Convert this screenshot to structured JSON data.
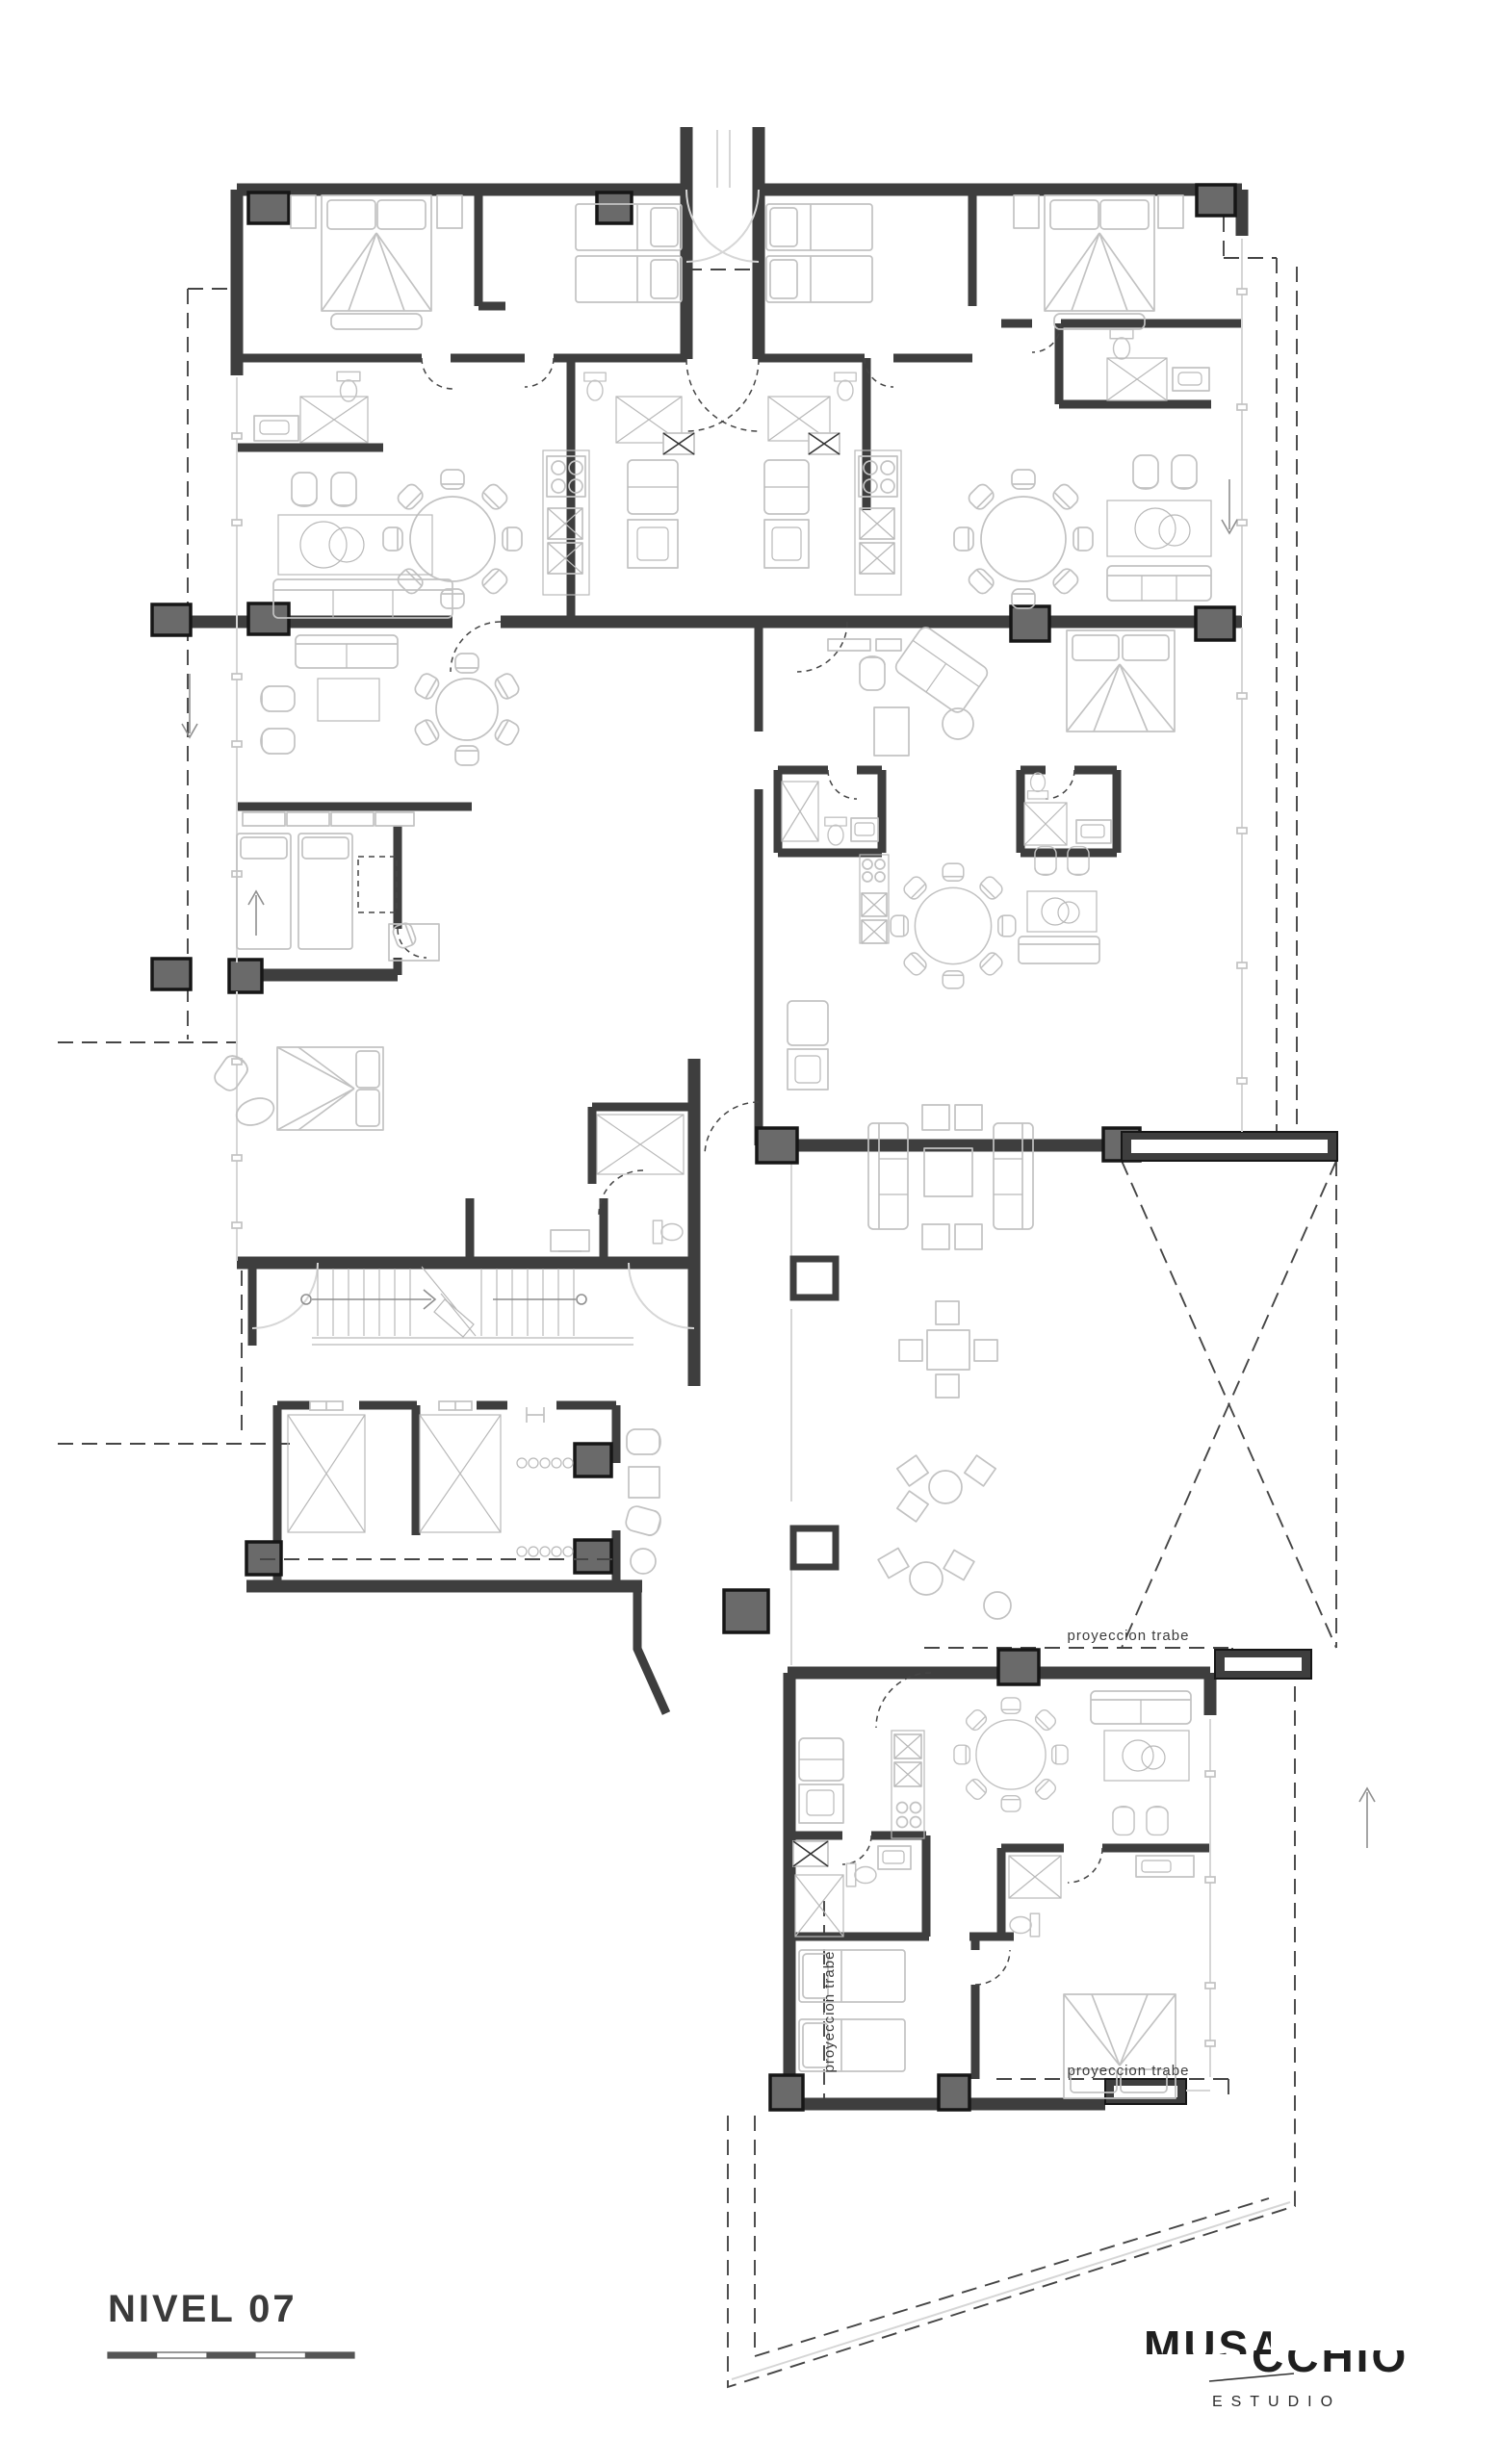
{
  "theme": {
    "bg": "#ffffff",
    "wall": "#3e3e3e",
    "column_fill": "#6a6a6a",
    "column_stroke": "#161616",
    "furniture": "#c2c2c2",
    "dash": "#454545",
    "light": "#d6d6d6",
    "ink": "#343434"
  },
  "drawing": {
    "type": "architectural-floor-plan",
    "level_title": "NIVEL 07",
    "annotations": {
      "beam_projection_1": "proyeccion trabe",
      "beam_projection_2": "proyeccion trabe",
      "beam_projection_3": "proyeccion trabe"
    }
  },
  "logo": {
    "word_top": "MUSA",
    "word_bottom": "CCHIO",
    "subtitle": "ESTUDIO"
  },
  "scale_bar": {
    "segments": 5
  }
}
